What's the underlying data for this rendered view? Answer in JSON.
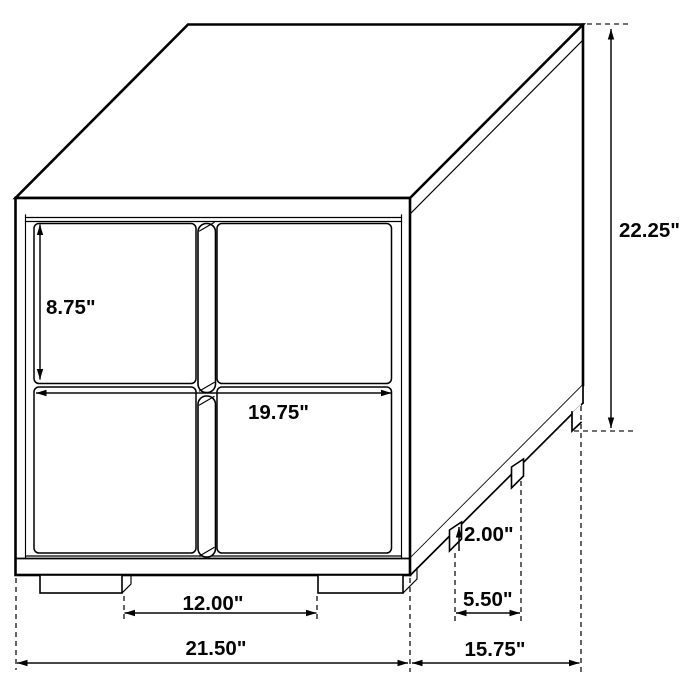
{
  "diagram": {
    "background": "#ffffff",
    "ink_color": "#000000",
    "dimensions": {
      "drawer_height": "8.75\"",
      "drawer_width": "19.75\"",
      "overall_height": "22.25\"",
      "leg_height": "2.00\"",
      "side_leg_gap": "5.50\"",
      "front_leg_gap": "12.00\"",
      "overall_width": "21.50\"",
      "overall_depth": "15.75\""
    }
  }
}
